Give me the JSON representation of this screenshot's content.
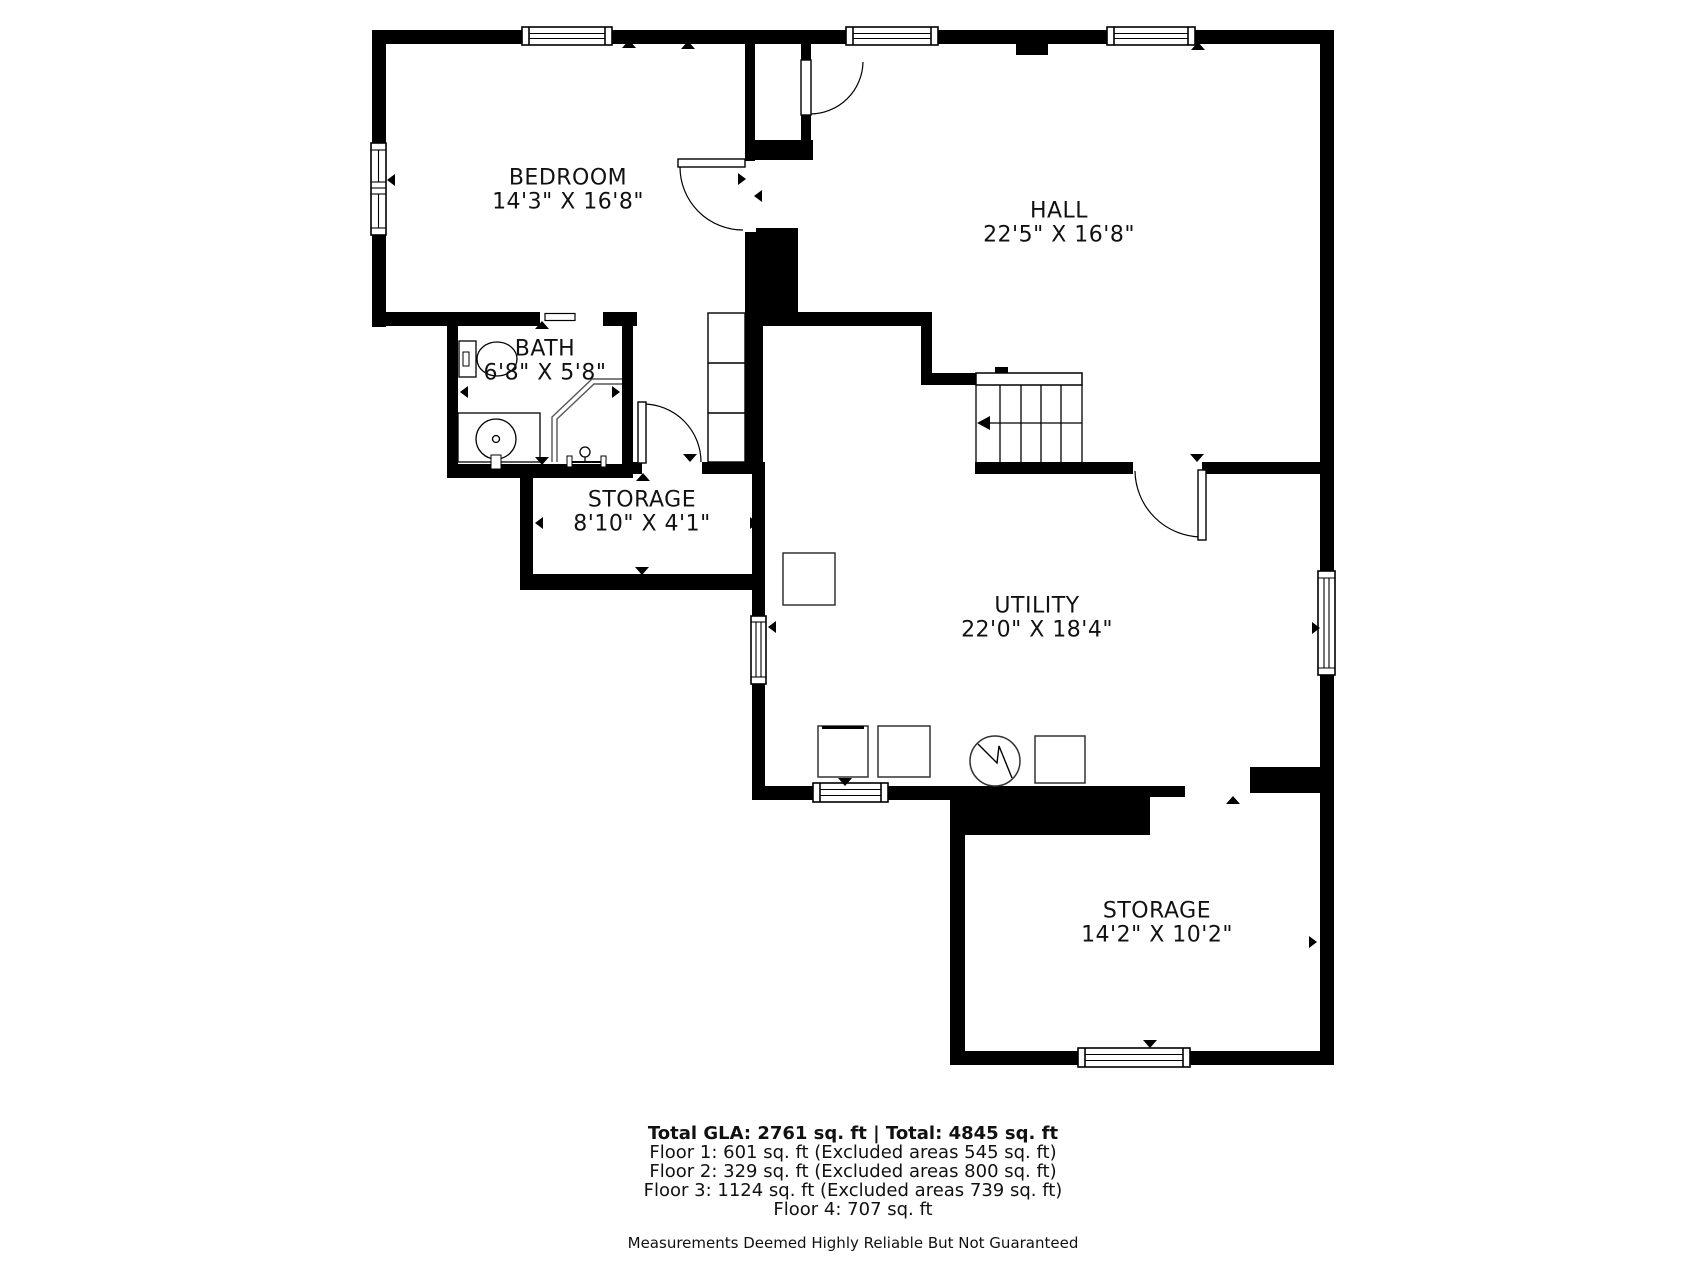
{
  "page": {
    "background": "#ffffff",
    "wall_color": "#000000",
    "text_color": "#111111"
  },
  "rooms": {
    "bedroom": {
      "name": "BEDROOM",
      "dims": "14'3\" X 16'8\""
    },
    "hall": {
      "name": "HALL",
      "dims": "22'5\" X 16'8\""
    },
    "bath": {
      "name": "BATH",
      "dims": "6'8\" X 5'8\""
    },
    "storage_small": {
      "name": "STORAGE",
      "dims": "8'10\" X 4'1\""
    },
    "utility": {
      "name": "UTILITY",
      "dims": "22'0\" X 18'4\""
    },
    "storage_lower": {
      "name": "STORAGE",
      "dims": "14'2\" X 10'2\""
    }
  },
  "footer": {
    "total_line": "Total GLA: 2761 sq. ft | Total: 4845 sq. ft",
    "floor_lines": [
      "Floor 1: 601 sq. ft (Excluded areas 545 sq. ft)",
      "Floor 2: 329 sq. ft (Excluded areas 800 sq. ft)",
      "Floor 3: 1124 sq. ft (Excluded areas 739 sq. ft)",
      "Floor 4: 707 sq. ft"
    ],
    "disclaimer": "Measurements Deemed Highly Reliable But Not Guaranteed"
  }
}
